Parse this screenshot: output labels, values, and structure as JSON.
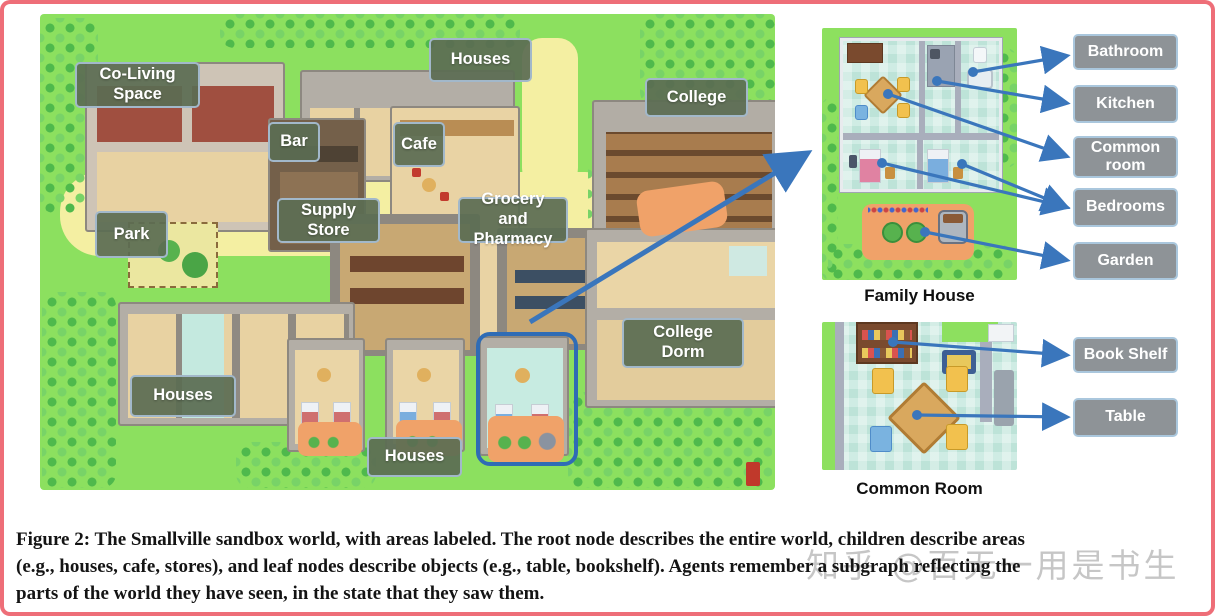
{
  "map": {
    "area_labels": [
      {
        "id": "co-living-space",
        "label": "Co-Living Space"
      },
      {
        "id": "houses-top",
        "label": "Houses"
      },
      {
        "id": "college",
        "label": "College"
      },
      {
        "id": "bar",
        "label": "Bar"
      },
      {
        "id": "cafe",
        "label": "Cafe"
      },
      {
        "id": "supply-store",
        "label": "Supply Store"
      },
      {
        "id": "grocery-pharmacy",
        "label": "Grocery and Pharmacy"
      },
      {
        "id": "park",
        "label": "Park"
      },
      {
        "id": "houses-left",
        "label": "Houses"
      },
      {
        "id": "college-dorm",
        "label": "College Dorm"
      },
      {
        "id": "houses-bottom",
        "label": "Houses"
      }
    ]
  },
  "insets": {
    "family_house": {
      "caption": "Family House",
      "labels": {
        "bathroom": "Bathroom",
        "kitchen": "Kitchen",
        "common_room": "Common room",
        "bedrooms": "Bedrooms",
        "garden": "Garden"
      }
    },
    "common_room": {
      "caption": "Common Room",
      "labels": {
        "book_shelf": "Book Shelf",
        "table": "Table"
      }
    }
  },
  "caption": {
    "lines": [
      "Figure 2: The Smallville sandbox world, with areas labeled. The root node describes the entire world, children describe areas",
      "(e.g., houses, cafe, stores), and leaf nodes describe objects (e.g., table, bookshelf). Agents remember a subgraph reflecting the",
      "parts of the world they have seen, in the state that they saw them."
    ]
  },
  "watermark": "知乎 @百无一用是书生",
  "colors": {
    "arrow_blue": "#3a76bc",
    "map_label_green": "#5b6d53",
    "right_label_gray": "#8e9397",
    "frame_pink": "#ee6e78",
    "highlight_blue": "#2f6cb5",
    "grass_green": "#8ce05f",
    "path_yellow": "#f4efa2"
  }
}
